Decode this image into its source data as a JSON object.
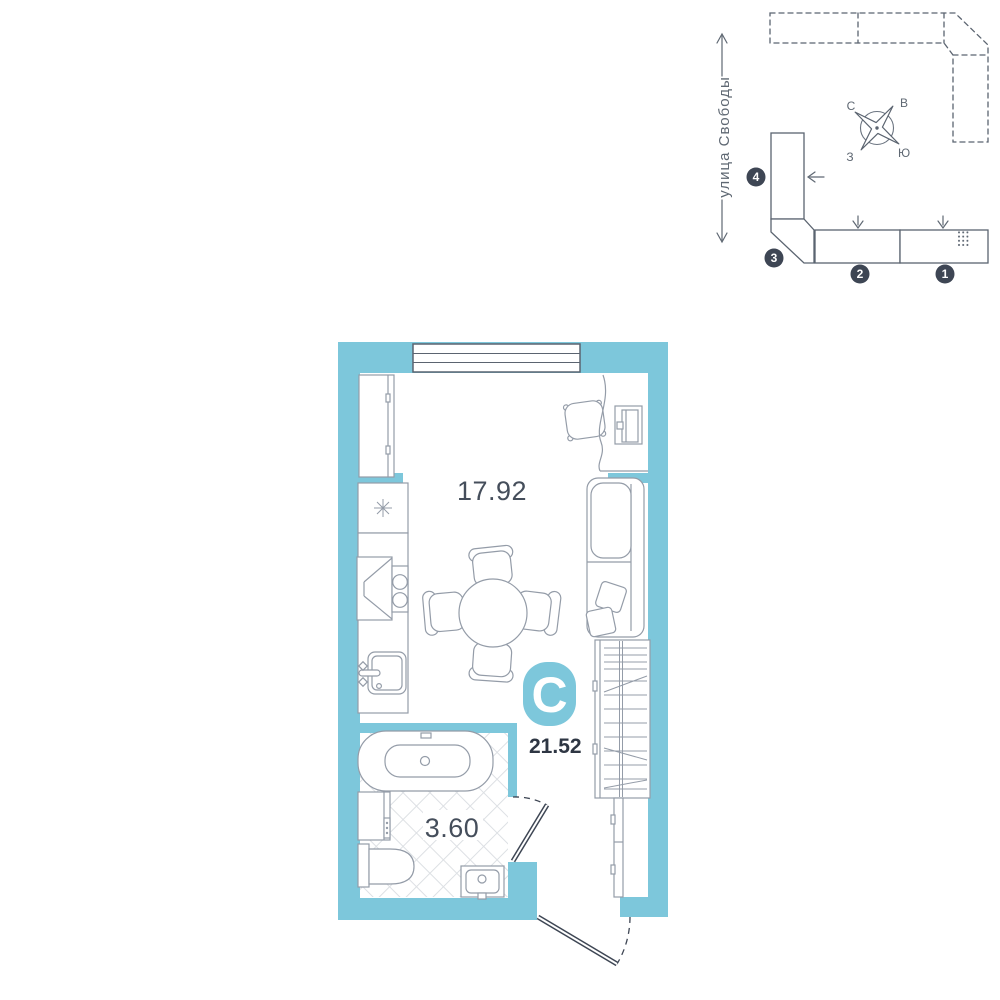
{
  "colors": {
    "wall_teal": "#7dc7db",
    "door_slate": "#3e4654",
    "site_outline": "#5b6470",
    "furniture_gray": "#949ca8",
    "hatch_gray": "#dde0e4",
    "badge_dark": "#3e4654"
  },
  "site_plan": {
    "street_label": "улица Свободы",
    "compass": {
      "north": "С",
      "east": "В",
      "south": "Ю",
      "west": "З"
    },
    "badges": [
      {
        "label": "1"
      },
      {
        "label": "2"
      },
      {
        "label": "3"
      },
      {
        "label": "4"
      }
    ]
  },
  "floor_plan": {
    "type_letter": "С",
    "total_area": "21.52",
    "room_area": "17.92",
    "bathroom_area": "3.60"
  }
}
